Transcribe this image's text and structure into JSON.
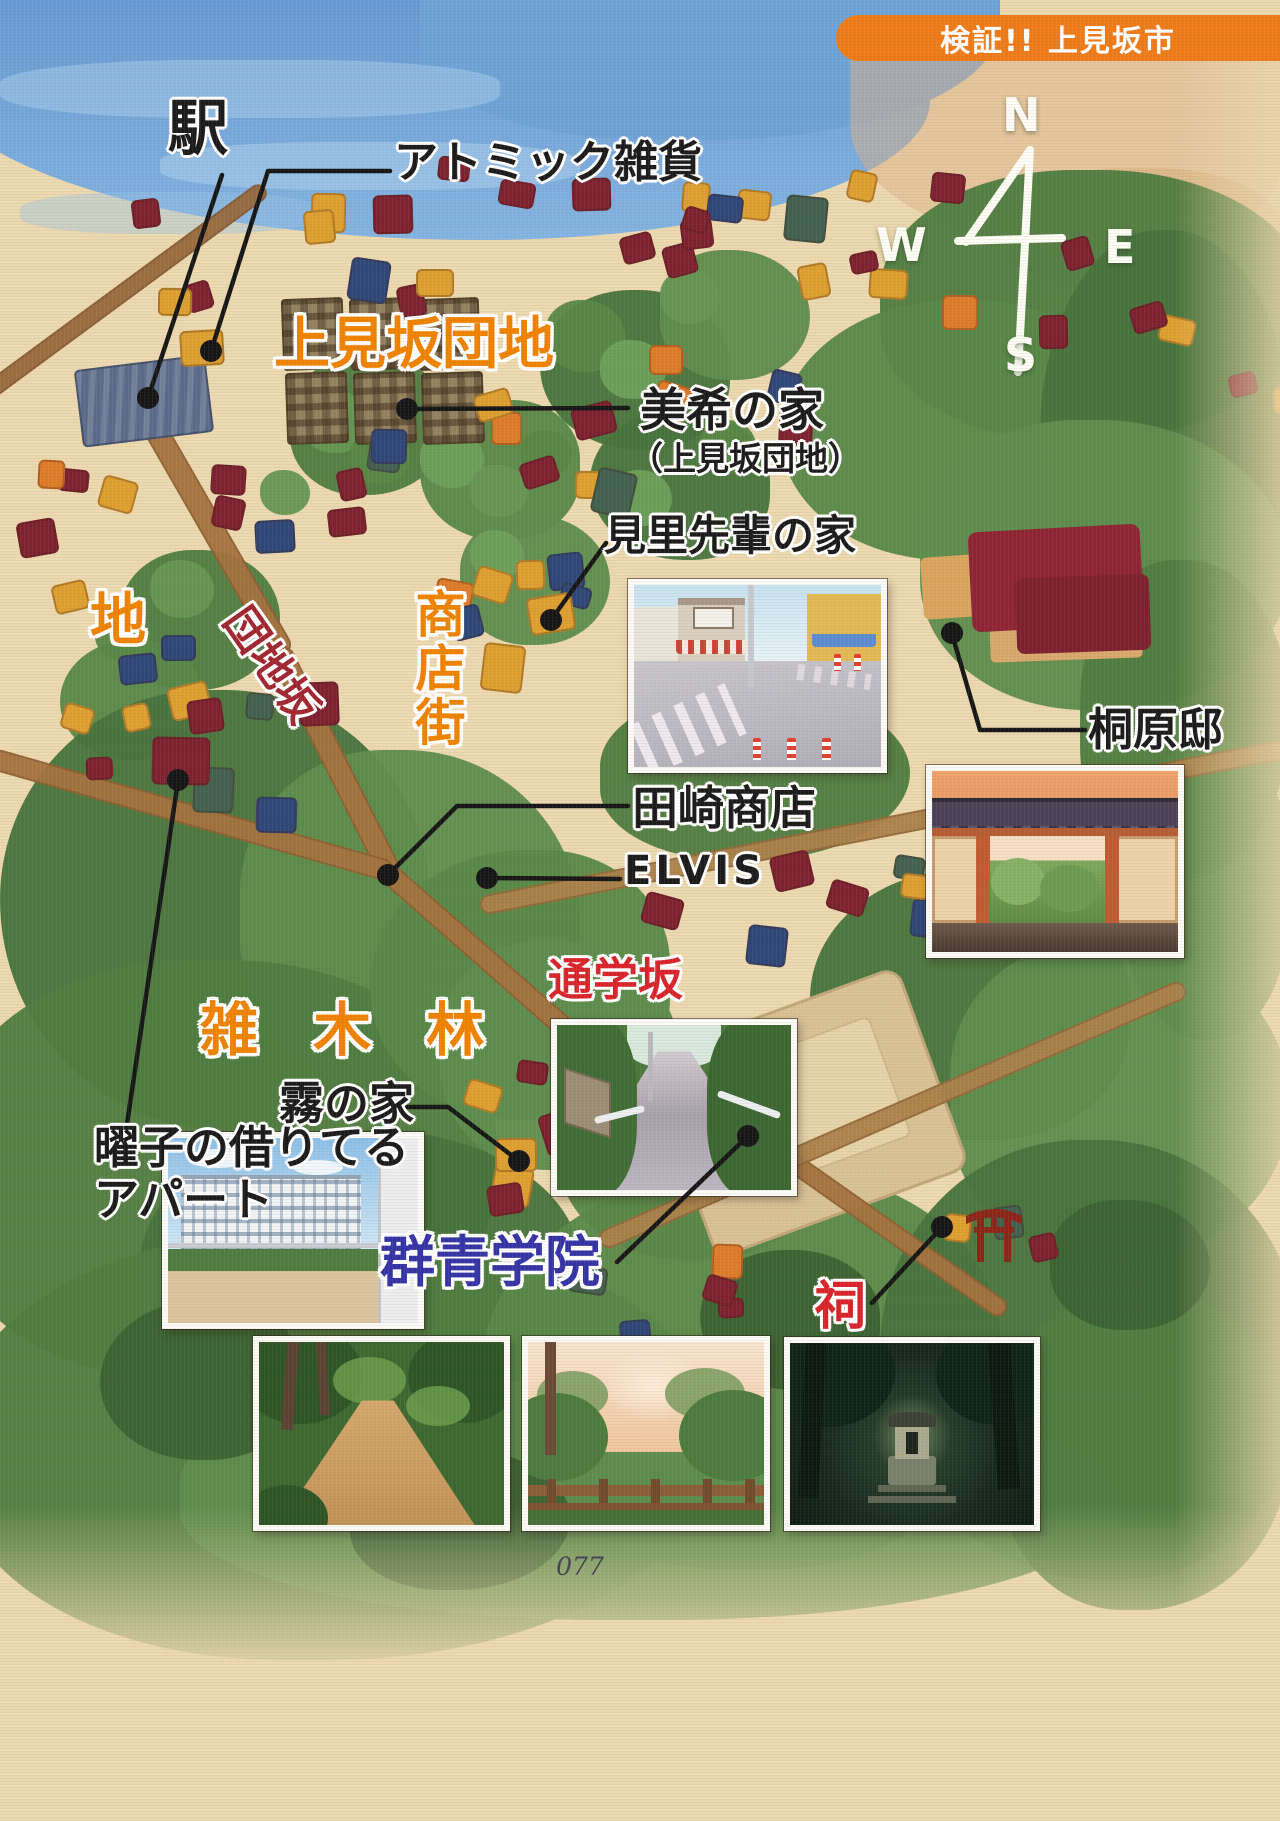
{
  "badge": {
    "text": "検証!! 上見坂市"
  },
  "compass": {
    "north": "N",
    "west": "W",
    "east": "E",
    "south": "S"
  },
  "labels": {
    "station": "駅",
    "atomic_zakka": "アトミック雑貨",
    "kamimisaka_danchi": "上見坂団地",
    "miki_house": "美希の家",
    "miki_house_note": "（上見坂団地）",
    "misato_senpai_house": "見里先輩の家",
    "chi": "地",
    "danchi_zaka": "団地坂",
    "shoutengai": "商店街",
    "kirihara_residence": "桐原邸",
    "tasaki_shouten": "田崎商店",
    "elvis": "ELVIS",
    "zoukibayashi": "雑木林",
    "tsuugaku_zaka": "通学坂",
    "youko_apartment_line1": "曜子の借りてる",
    "youko_apartment_line2": "アパート",
    "kiri_house": "霧の家",
    "gunjou_gakuin": "群青学院",
    "hokora": "祠"
  },
  "page_number": "077",
  "colors": {
    "badge_orange": "#ee7b18",
    "label_orange": "#ef8200",
    "label_red": "#d8232a",
    "slope_dark_red": "#a02530",
    "school_blue": "#3333a6",
    "paper": "#ecd9b0",
    "forest_green": "#4e7c41"
  }
}
